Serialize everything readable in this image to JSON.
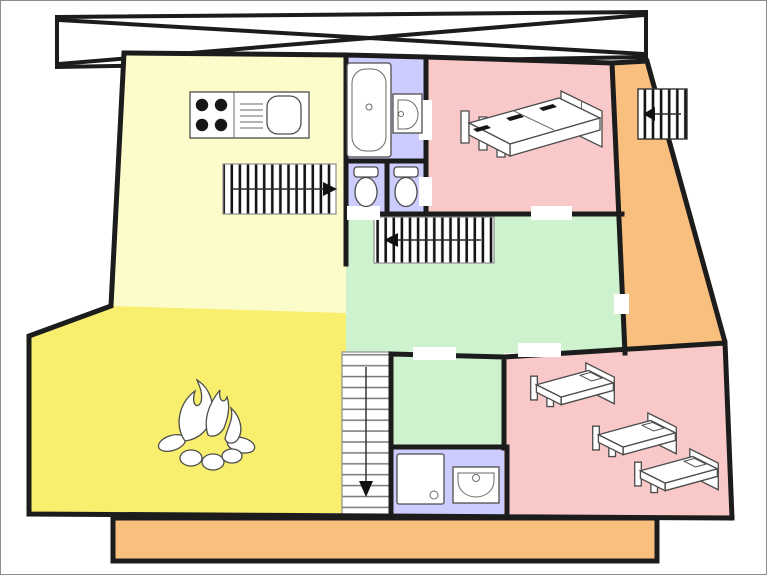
{
  "diagram_type": "floor-plan",
  "colors": {
    "background": "#ffffff",
    "frame_border": "#8d8d8d",
    "wall": "#1c1c1c",
    "door_gap": "#ffffff",
    "balcony": "#c9c9c9",
    "kitchen": "#fcfccb",
    "bathroom": "#ccccfe",
    "wc": "#ccccfe",
    "double_bedroom": "#f9c8c8",
    "side_corridor": "#f8bf7e",
    "hall": "#cdf2cd",
    "landing": "#cdf2cd",
    "living_room": "#f9ef6e",
    "shower_room": "#ccccfe",
    "dormitory": "#f9c8c8",
    "terrace": "#f8bf7e",
    "stair_fill": "#ffffff"
  },
  "rooms": [
    {
      "id": "balcony",
      "name": "balcony with cross bracing",
      "fixtures": []
    },
    {
      "id": "kitchen",
      "name": "kitchen",
      "fixtures": [
        "stove-four-burners",
        "kitchen-sink-with-drainboard"
      ]
    },
    {
      "id": "bathroom",
      "name": "bathroom",
      "fixtures": [
        "bathtub",
        "washbasin"
      ]
    },
    {
      "id": "wc-left",
      "name": "wc",
      "fixtures": [
        "toilet"
      ]
    },
    {
      "id": "wc-right",
      "name": "wc",
      "fixtures": [
        "toilet"
      ]
    },
    {
      "id": "double-bedroom",
      "name": "bedroom",
      "fixtures": [
        "double-bed"
      ]
    },
    {
      "id": "side-corridor",
      "name": "side corridor",
      "fixtures": []
    },
    {
      "id": "hall",
      "name": "hall",
      "fixtures": []
    },
    {
      "id": "landing",
      "name": "landing",
      "fixtures": []
    },
    {
      "id": "living-room",
      "name": "living room",
      "fixtures": [
        "open-campfire-fireplace"
      ]
    },
    {
      "id": "shower-room",
      "name": "shower room",
      "fixtures": [
        "shower-tray",
        "washbasin"
      ]
    },
    {
      "id": "dormitory",
      "name": "dormitory",
      "fixtures": [
        "single-bed",
        "single-bed",
        "single-bed"
      ]
    },
    {
      "id": "terrace",
      "name": "terrace",
      "fixtures": []
    }
  ],
  "stairs": [
    {
      "id": "kitchen-stairs",
      "direction": "right"
    },
    {
      "id": "hall-stairs",
      "direction": "left"
    },
    {
      "id": "main-stairs",
      "direction": "down"
    },
    {
      "id": "outdoor-stairs",
      "direction": "left"
    }
  ]
}
